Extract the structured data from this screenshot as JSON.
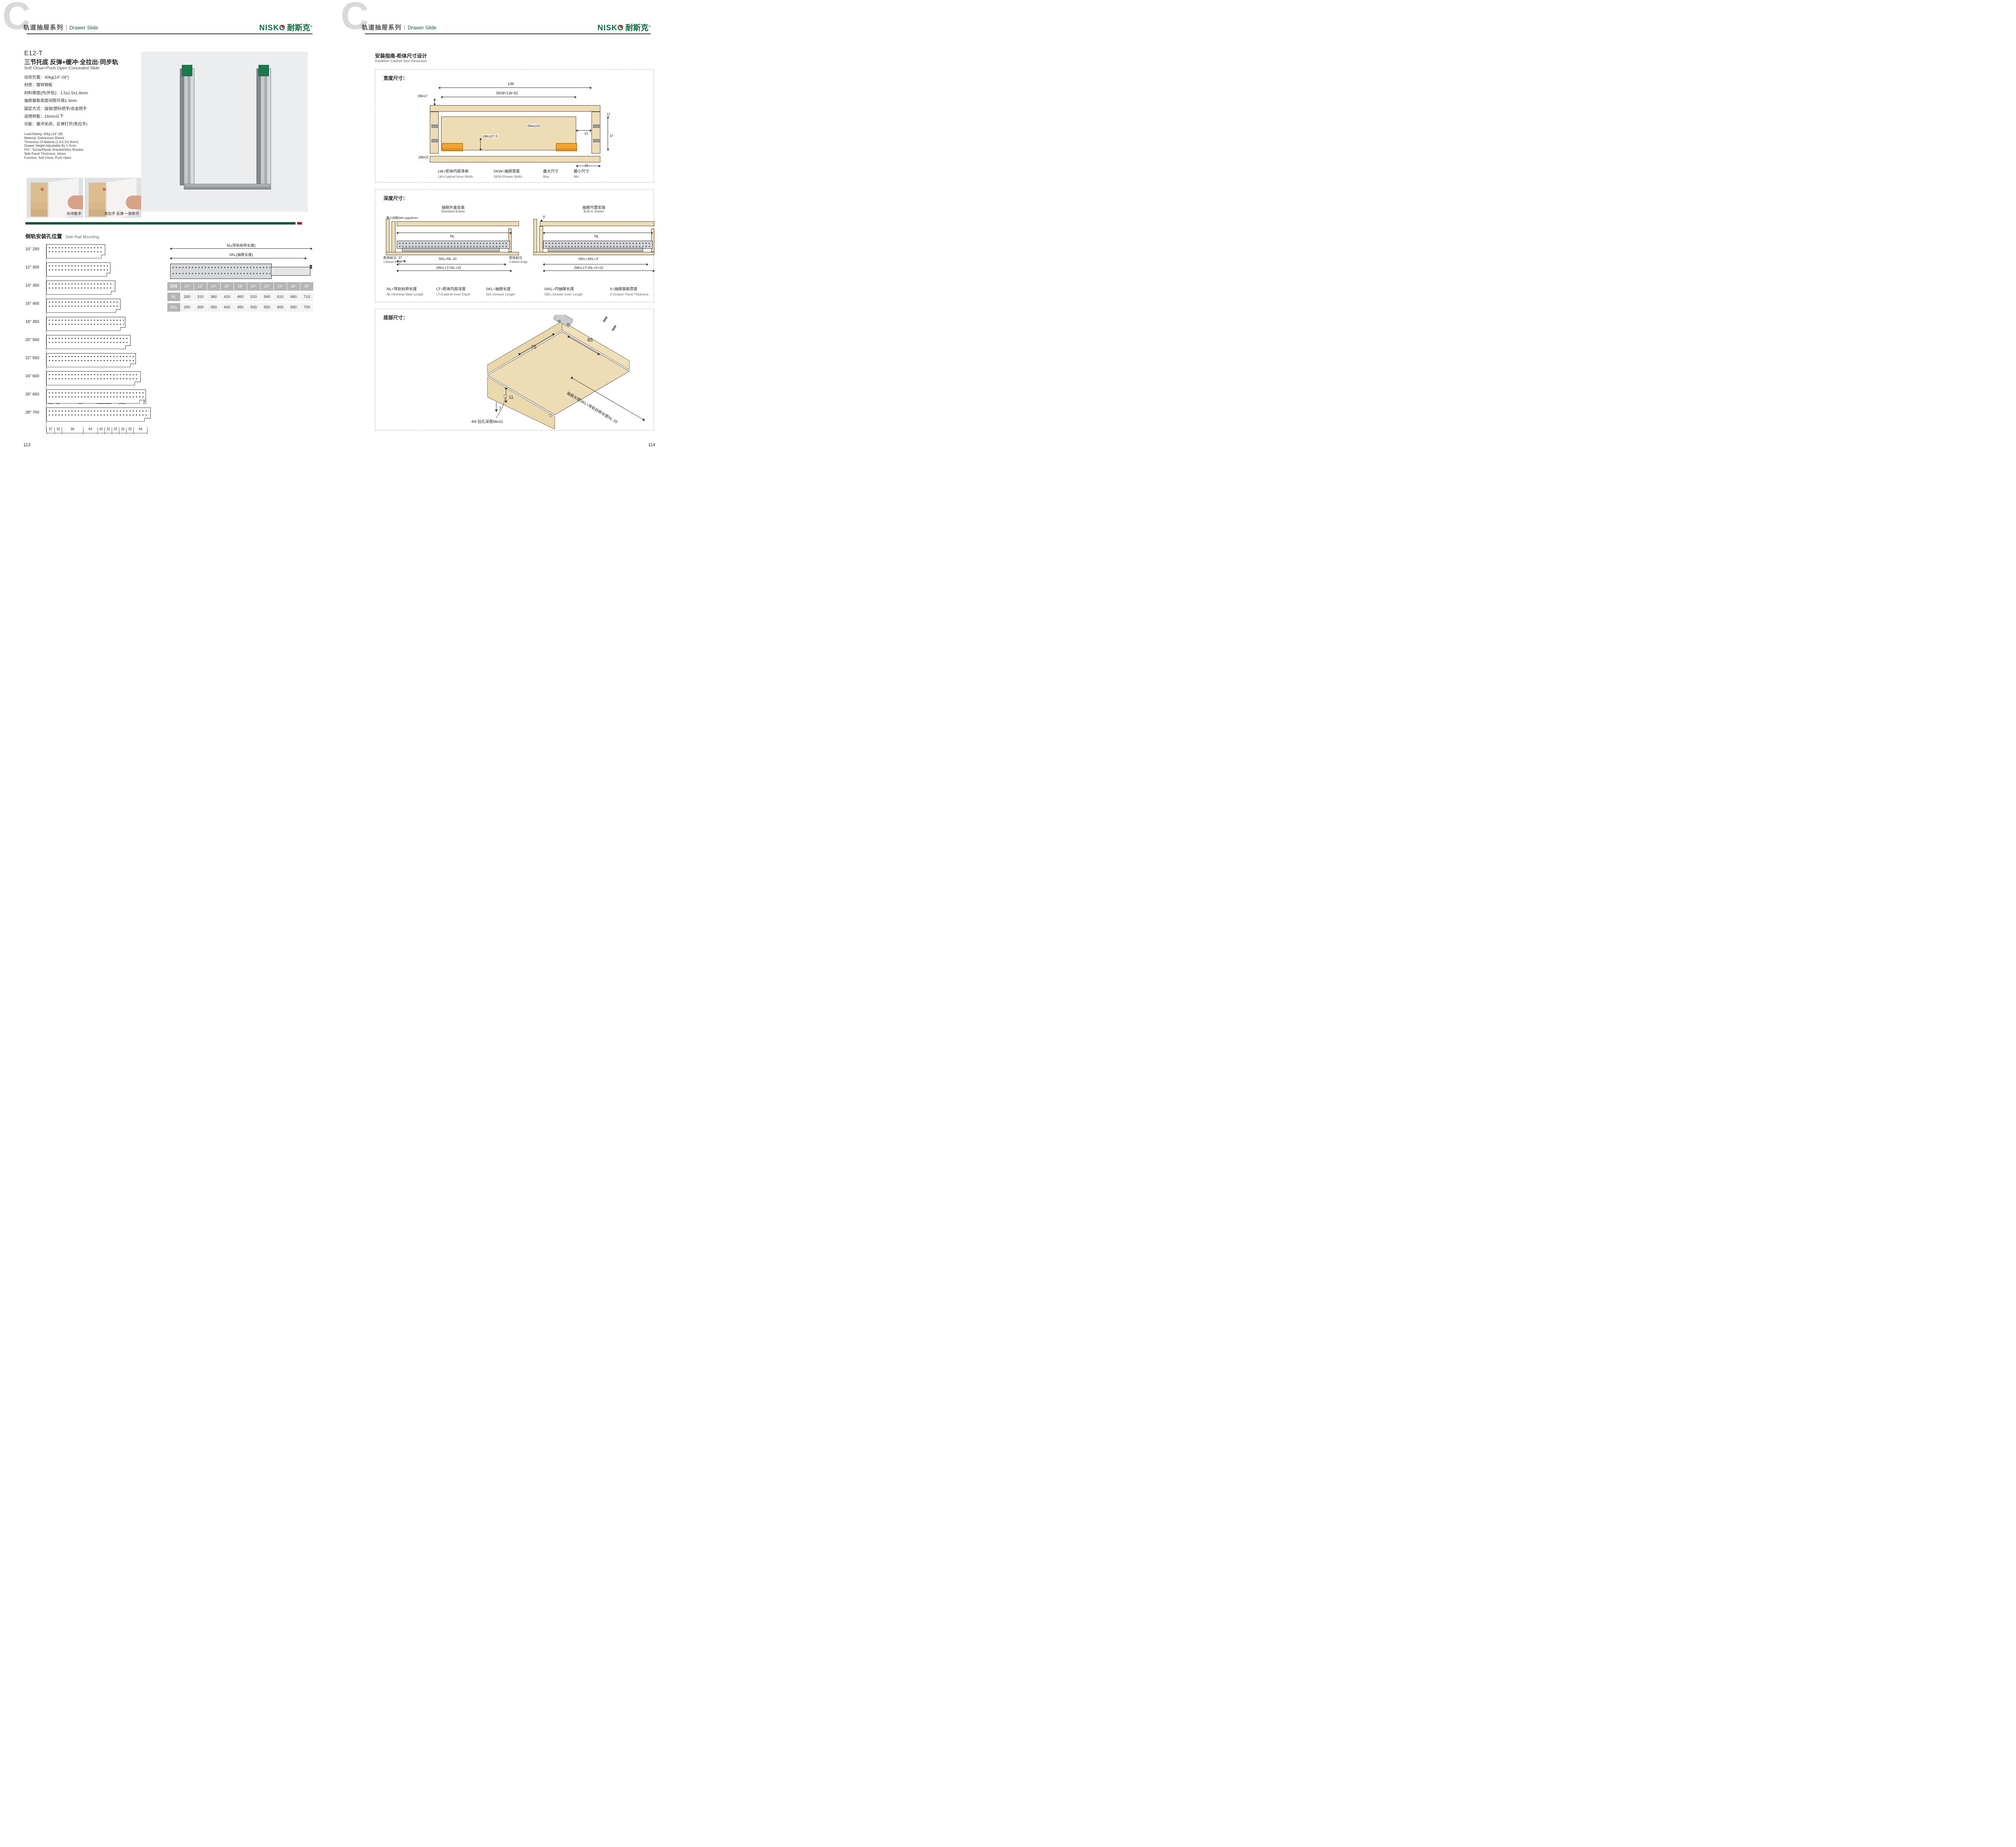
{
  "colors": {
    "brand_green": "#0e6b3f",
    "header_green": "#1e5c44",
    "bar_green": "#1d5b40",
    "bar_red": "#b5242c",
    "accent_red": "#ce3128",
    "tan": "#eeddb4",
    "table_gray": "#b2b4b6"
  },
  "header": {
    "section_letter": "C",
    "series_zh": "轨道抽屉系列",
    "series_en": "Drawer Slide"
  },
  "brand": {
    "latin": "NISKO",
    "zh": "耐斯克",
    "reg": "®"
  },
  "left": {
    "product": {
      "model": "E12-T",
      "title_zh": "三节托底 反弹+缓冲·全拉出·同步轨",
      "title_en": "Soft Close+Push Open Concealed Slide",
      "specs_zh": [
        "动态负载：40kg(14\"-28\")",
        "材质：镀锌钢板",
        "材料厚度(内/外轨)：1.5x1.5x1.8mm",
        "抽屉面板高度间隙可调1-3mm",
        "固定方式：插销/塑料把手/合金把手",
        "适用侧板：16mm以下",
        "功能：缓冲关闭，反弹打开(免拉手)"
      ],
      "specs_en": [
        "Load Rating: 40kg (14\"-28)",
        "Material: Galvanized Sheed",
        "Thickness Of Materia (1.5/1.5/1.8mm)",
        "Drawer Height Adjustable By 1-3mm",
        "FIX：Screw/Plastic Bracket/Alloy Bracket",
        "Side Panel Thickness: 16mm",
        "Function: Soft Close, Push Open"
      ],
      "photo_captions": [
        "关闭缓冲",
        "免拉手 反弹 一按即开"
      ]
    },
    "side_rail": {
      "title_zh": "侧轨安装孔位置",
      "title_en": "Side Rail Mounting",
      "rows": [
        {
          "label": "10\" 250",
          "nl": 260
        },
        {
          "label": "12\" 300",
          "nl": 310
        },
        {
          "label": "14\" 350",
          "nl": 360
        },
        {
          "label": "16\" 400",
          "nl": 410
        },
        {
          "label": "18\" 450",
          "nl": 460
        },
        {
          "label": "20\" 500",
          "nl": 510
        },
        {
          "label": "22\" 550",
          "nl": 560
        },
        {
          "label": "24\" 600",
          "nl": 610
        },
        {
          "label": "26\" 650",
          "nl": 660
        },
        {
          "label": "28\" 700",
          "nl": 710
        }
      ],
      "top_dims": [
        "999",
        "32",
        "99",
        "1499",
        "1499",
        "1499",
        "99"
      ],
      "bottom_dims": [
        37,
        32,
        96,
        64,
        32,
        32,
        32,
        32,
        32,
        64
      ],
      "nl_label": "NL(导轨标称长度)",
      "skl_label": "SKL(抽屉长度)",
      "table": {
        "header": [
          "规格",
          "10\"",
          "12\"",
          "14\"",
          "16\"",
          "18\"",
          "20\"",
          "22\"",
          "24\"",
          "26\"",
          "28\""
        ],
        "rows": [
          {
            "label": "NL",
            "values": [
              "260",
              "310",
              "360",
              "410",
              "460",
              "510",
              "560",
              "610",
              "660",
              "710"
            ]
          },
          {
            "label": "SKL",
            "values": [
              "250",
              "300",
              "350",
              "400",
              "450",
              "500",
              "550",
              "600",
              "650",
              "700"
            ]
          }
        ]
      }
    },
    "page_number": "113"
  },
  "right": {
    "section": {
      "title_zh": "安装指南-柜体尺寸设计",
      "title_en": "Installtion Cabinet Size Dimension"
    },
    "width_box": {
      "title": "宽度尺寸：",
      "lw": "LW",
      "skw": "SKW=LW-42",
      "min7": "(Min)7",
      "max16": "(Max)16",
      "min275": "(Min)27.5",
      "min3": "(Min)3",
      "d12": "12",
      "d10": "10",
      "d37": "37",
      "d21": "21",
      "legend": [
        {
          "zh": "LW=柜体内部净高",
          "en": "LW=Cabinet Inner Width"
        },
        {
          "zh": "SKW=抽屉宽度",
          "en": "SKW=Drawer Width"
        },
        {
          "zh": "最大尺寸",
          "en": "Max"
        },
        {
          "zh": "最小尺寸",
          "en": "Min"
        }
      ]
    },
    "depth_box": {
      "title": "深度尺寸：",
      "standard": {
        "title_zh": "抽屉外盖安装",
        "title_en": "Standard drawer",
        "min_gap": "最小间隙(Min gap)4mm",
        "nl": "NL",
        "d37": "37",
        "skl": "SKL=NL-10",
        "lt": "(Min) LT=NL+10",
        "edge_zh": "柜体前沿",
        "edge_en": "Cabinet Edge"
      },
      "builtin": {
        "title_zh": "抽屉内置安装",
        "title_en": "Built-in drawer",
        "x": "X",
        "nl": "NL",
        "iskl": "ISKL=SKL+X",
        "lt": "(Min) LT=NL+X+10",
        "edge_zh": "柜体前沿",
        "edge_en": "Cabinet Edge"
      },
      "legend": [
        {
          "zh": "NL=导轨标称长度",
          "en": "NL=Nominal Slide Length"
        },
        {
          "zh": "LT=柜体内部深度",
          "en": "LT=Cabinet Inner Depth"
        },
        {
          "zh": "SKL=抽屉长度",
          "en": "SKL=Drawer Length"
        },
        {
          "zh": "ISKL=内抽屉长度",
          "en": "ISKL=Drawer Inner Length"
        },
        {
          "zh": "X=抽屉面板厚度",
          "en": "X=Drawer Panel Thickness"
        }
      ]
    },
    "bottom_box": {
      "title": "底部尺寸：",
      "d75": "75",
      "d85": "85",
      "d11": "11",
      "d7": "7",
      "drill": "Φ6 钻孔深度Min11",
      "skl_note": "抽屉长度SKL=导轨标称长度NL-10"
    },
    "page_number": "114"
  }
}
